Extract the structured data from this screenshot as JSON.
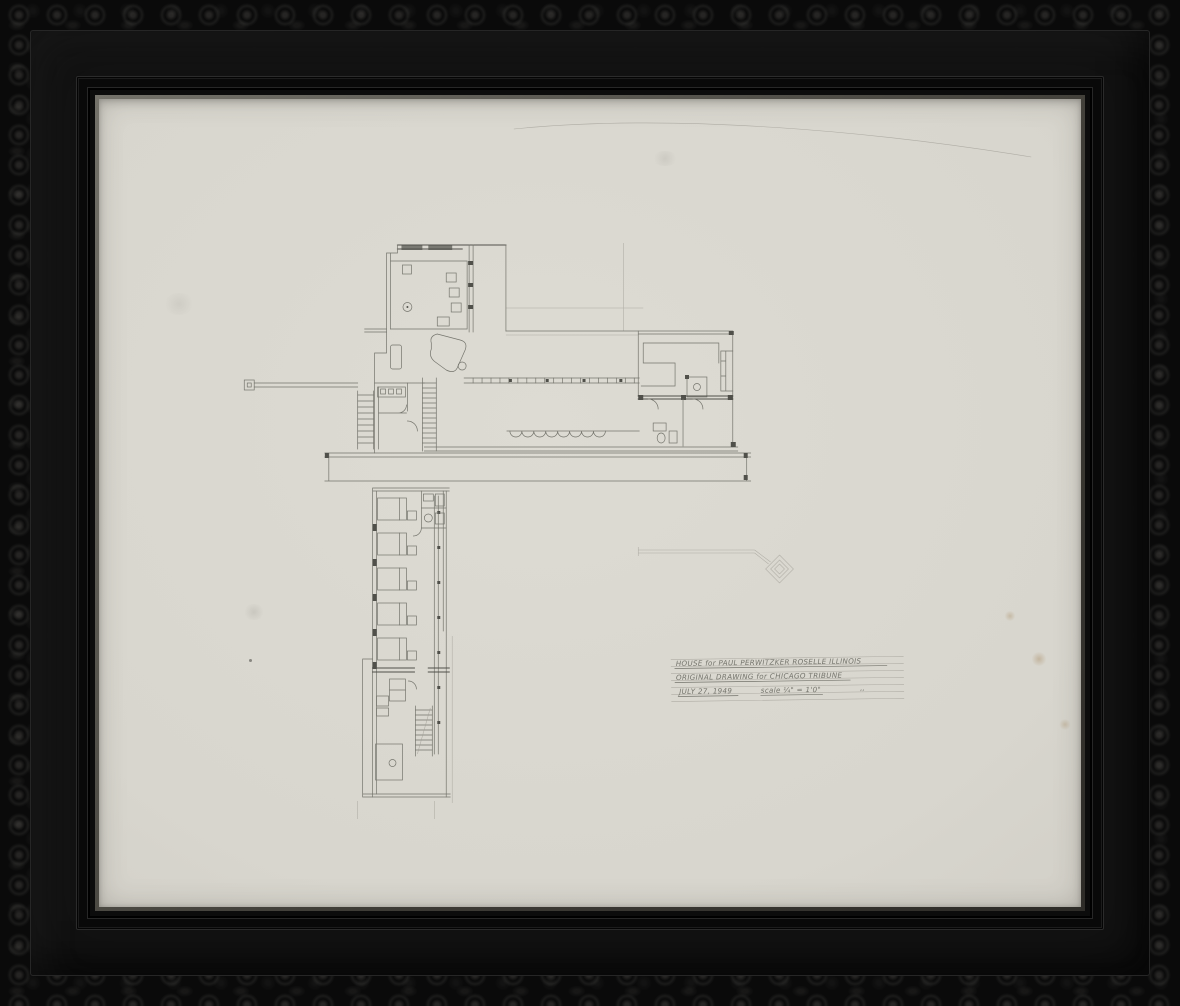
{
  "colors": {
    "pencil": "#74746c",
    "pencil_dark": "#50504a",
    "pencil_faint": "#a09e95",
    "paper": "#d8d6ce",
    "frame_black": "#0c0c0c",
    "lip_gray": "#55534b",
    "stain_brown": "#967548"
  },
  "artwork": {
    "alt": "Framed graphite architectural floor-plan drawing in an ornate carved black frame"
  },
  "title_block": {
    "line1": "HOUSE for PAUL PERWITZKER   ROSELLE ILLINOIS",
    "line2": "ORIGINAL DRAWING for CHICAGO TRIBUNE",
    "line3_date": "JULY 27, 1949",
    "line3_scale": "scale ¼\" = 1'0\"",
    "ditto_mark": ",,"
  }
}
